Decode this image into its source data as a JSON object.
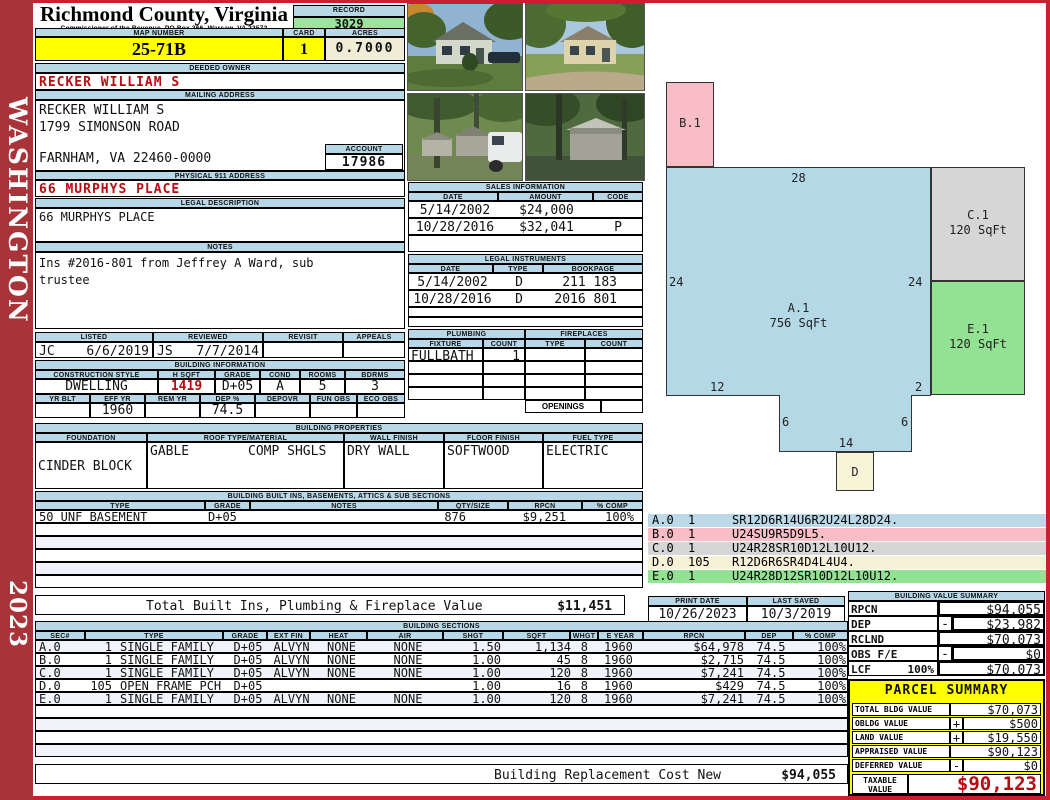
{
  "frame": {
    "county_label": "WASHINGTON",
    "year_label": "2023"
  },
  "colors": {
    "frame_red": "#c5222f",
    "sidebar_red": "#a83338",
    "header_blue": "#b9d8e7",
    "highlight_yellow": "#ffff00",
    "record_green": "#9be49b",
    "alert_red": "#b50d12",
    "sketch_blue": "#b5d8e6",
    "sketch_pink": "#f9bdc5",
    "sketch_gray": "#d6d6d6",
    "sketch_green": "#93e193",
    "sketch_cream": "#f8f4d8"
  },
  "header": {
    "title": "Richmond County, Virginia",
    "subtitle": "Commissioner of the Revenue, PO Box 366, Warsaw, VA 22572",
    "record_label": "RECORD",
    "record_value": "3029",
    "map_number_label": "MAP NUMBER",
    "map_number": "25-71B",
    "card_label": "CARD",
    "card": "1",
    "acres_label": "ACRES",
    "acres": "0.7000"
  },
  "owner": {
    "deeded_owner_label": "DEEDED OWNER",
    "deeded_owner": "RECKER WILLIAM S",
    "mailing_address_label": "MAILING ADDRESS",
    "mailing_line1": "RECKER WILLIAM S",
    "mailing_line2": "1799 SIMONSON ROAD",
    "mailing_line3": "FARNHAM, VA 22460-0000",
    "account_label": "ACCOUNT",
    "account": "17986",
    "physical_address_label": "PHYSICAL 911 ADDRESS",
    "physical_address": "66 MURPHYS PLACE",
    "legal_description_label": "LEGAL DESCRIPTION",
    "legal_description": "66 MURPHYS PLACE",
    "notes_label": "NOTES",
    "notes": "Ins #2016-801 from Jeffrey A Ward, sub trustee"
  },
  "photos": {
    "count": 4
  },
  "visits": {
    "headers": [
      "LISTED",
      "REVIEWED",
      "REVISIT",
      "APPEALS"
    ],
    "listed_by": "JC",
    "listed_date": "6/6/2019",
    "reviewed_by": "JS",
    "reviewed_date": "7/7/2014",
    "revisit": "",
    "appeals": ""
  },
  "building_info": {
    "label": "BUILDING INFORMATION",
    "row1_headers": [
      "CONSTRUCTION STYLE",
      "H SQFT",
      "GRADE",
      "COND",
      "ROOMS",
      "BDRMS"
    ],
    "construction_style": "DWELLING",
    "h_sqft": "1419",
    "grade": "D+05",
    "cond": "A",
    "rooms": "5",
    "bdrms": "3",
    "row2_headers": [
      "YR BLT",
      "EFF YR",
      "REM YR",
      "DEP %",
      "DEPOVR",
      "FUN OBS",
      "ECO OBS"
    ],
    "yr_blt": "",
    "eff_yr": "1960",
    "rem_yr": "",
    "dep_pct": "74.5",
    "depovr": "",
    "fun_obs": "",
    "eco_obs": ""
  },
  "sales": {
    "label": "SALES INFORMATION",
    "headers": [
      "DATE",
      "AMOUNT",
      "CODE"
    ],
    "rows": [
      [
        "5/14/2002",
        "$24,000",
        ""
      ],
      [
        "10/28/2016",
        "$32,041",
        "P"
      ]
    ]
  },
  "legal_instruments": {
    "label": "LEGAL INSTRUMENTS",
    "headers": [
      "DATE",
      "TYPE",
      "BOOKPAGE"
    ],
    "rows": [
      [
        "5/14/2002",
        "D",
        "211 183"
      ],
      [
        "10/28/2016",
        "D",
        "2016 801"
      ]
    ]
  },
  "plumbing": {
    "label": "PLUMBING",
    "headers": [
      "FIXTURE",
      "COUNT"
    ],
    "rows": [
      [
        "FULLBATH",
        "1"
      ]
    ]
  },
  "fireplaces": {
    "label": "FIREPLACES",
    "headers": [
      "TYPE",
      "COUNT"
    ],
    "openings_label": "OPENINGS",
    "openings_value": ""
  },
  "building_properties": {
    "label": "BUILDING PROPERTIES",
    "headers": [
      "FOUNDATION",
      "ROOF TYPE/MATERIAL",
      "WALL FINISH",
      "FLOOR FINISH",
      "FUEL TYPE"
    ],
    "foundation": "CINDER BLOCK",
    "roof_type": "GABLE",
    "roof_material": "COMP SHGLS",
    "wall_finish": "DRY WALL",
    "floor_finish": "SOFTWOOD",
    "fuel_type": "ELECTRIC"
  },
  "built_ins": {
    "label": "BUILDING BUILT INS, BASEMENTS, ATTICS & SUB SECTIONS",
    "headers": [
      "TYPE",
      "GRADE",
      "NOTES",
      "QTY/SIZE",
      "RPCN",
      "% COMP"
    ],
    "rows": [
      [
        "50 UNF BASEMENT",
        "D+05",
        "",
        "876",
        "$9,251",
        "100%"
      ]
    ],
    "total_label": "Total Built Ins, Plumbing & Fireplace Value",
    "total_value": "$11,451"
  },
  "building_sections": {
    "label": "BUILDING SECTIONS",
    "headers": [
      "SEC#",
      "TYPE",
      "GRADE",
      "EXT FIN",
      "HEAT",
      "AIR",
      "SHGT",
      "SQFT",
      "WHGT",
      "E YEAR",
      "RPCN",
      "DEP",
      "% COMP"
    ],
    "rows": [
      [
        "A.0",
        "1",
        "SINGLE FAMILY",
        "D+05",
        "ALVYN",
        "NONE",
        "NONE",
        "1.50",
        "1,134",
        "8",
        "1960",
        "$64,978",
        "74.5",
        "100%"
      ],
      [
        "B.0",
        "1",
        "SINGLE FAMILY",
        "D+05",
        "ALVYN",
        "NONE",
        "NONE",
        "1.00",
        "45",
        "8",
        "1960",
        "$2,715",
        "74.5",
        "100%"
      ],
      [
        "C.0",
        "1",
        "SINGLE FAMILY",
        "D+05",
        "ALVYN",
        "NONE",
        "NONE",
        "1.00",
        "120",
        "8",
        "1960",
        "$7,241",
        "74.5",
        "100%"
      ],
      [
        "D.0",
        "105",
        "OPEN FRAME PCH",
        "D+05",
        "",
        "",
        "",
        "1.00",
        "16",
        "8",
        "1960",
        "$429",
        "74.5",
        "100%"
      ],
      [
        "E.0",
        "1",
        "SINGLE FAMILY",
        "D+05",
        "ALVYN",
        "NONE",
        "NONE",
        "1.00",
        "120",
        "8",
        "1960",
        "$7,241",
        "74.5",
        "100%"
      ]
    ],
    "replacement_label": "Building Replacement Cost New",
    "replacement_value": "$94,055"
  },
  "sketch": {
    "areas": {
      "a": {
        "id": "A.1",
        "sqft": "756 SqFt"
      },
      "b": {
        "id": "B.1"
      },
      "c": {
        "id": "C.1",
        "sqft": "120 SqFt"
      },
      "d": {
        "id": "D"
      },
      "e": {
        "id": "E.1",
        "sqft": "120 SqFt"
      }
    },
    "dims": {
      "top": "28",
      "left": "24",
      "right": "24",
      "bottom_left": "12",
      "bottom_right": "2",
      "notch_left": "6",
      "notch_right": "6",
      "notch_width": "14"
    },
    "codes": [
      {
        "sec": "A.0",
        "count": "1",
        "code": "SR12D6R14U6R2U24L28D24."
      },
      {
        "sec": "B.0",
        "count": "1",
        "code": "U24SU9R5D9L5."
      },
      {
        "sec": "C.0",
        "count": "1",
        "code": "U24R28SR10D12L10U12."
      },
      {
        "sec": "D.0",
        "count": "105",
        "code": "R12D6R6SR4D4L4U4."
      },
      {
        "sec": "E.0",
        "count": "1",
        "code": "U24R28D12SR10D12L10U12."
      }
    ]
  },
  "dates": {
    "print_date_label": "PRINT DATE",
    "print_date": "10/26/2023",
    "last_saved_label": "LAST SAVED",
    "last_saved": "10/3/2019"
  },
  "value_summary": {
    "label": "BUILDING VALUE SUMMARY",
    "rpcn_label": "RPCN",
    "rpcn": "$94,055",
    "dep_label": "DEP",
    "dep_op": "-",
    "dep": "$23,982",
    "rclnd_label": "RCLND",
    "rclnd": "$70,073",
    "obs_label": "OBS F/E",
    "obs_op": "-",
    "obs": "$0",
    "lcf_label": "LCF",
    "lcf_pct": "100%",
    "lcf": "$70,073"
  },
  "parcel_summary": {
    "label": "PARCEL SUMMARY",
    "total_bldg_label": "TOTAL BLDG VALUE",
    "total_bldg": "$70,073",
    "obldg_label": "OBLDG VALUE",
    "obldg_op": "+",
    "obldg": "$500",
    "land_label": "LAND VALUE",
    "land_op": "+",
    "land": "$19,550",
    "appraised_label": "APPRAISED VALUE",
    "appraised": "$90,123",
    "deferred_label": "DEFERRED VALUE",
    "deferred_op": "-",
    "deferred": "$0",
    "taxable_label": "TAXABLE VALUE",
    "taxable": "$90,123"
  }
}
